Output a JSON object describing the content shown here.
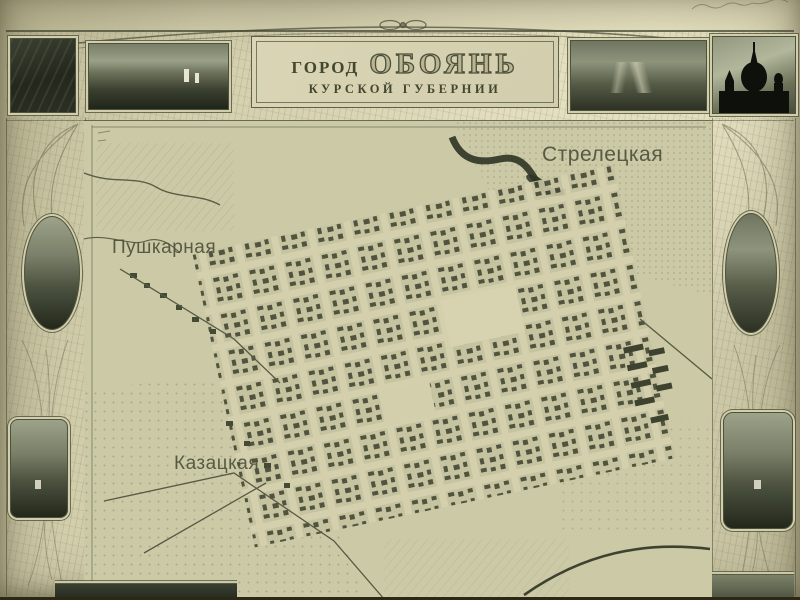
{
  "title": {
    "prefix": "ГОРОД",
    "name": "ОБОЯНЬ",
    "subtitle": "КУРСКОЙ ГУБЕРНИИ"
  },
  "map": {
    "districts": [
      {
        "label": "Стрелецкая"
      },
      {
        "label": "Пушкарная"
      },
      {
        "label": "Казацкая"
      }
    ]
  },
  "photos": {
    "top_left_corner": "dark town view",
    "top_left_panorama": "town panorama with white church",
    "top_right_panorama": "town panorama with winding road",
    "top_right_corner": "cathedral silhouette against sky",
    "left_oval": "town rooftops view",
    "right_oval": "river landscape view",
    "left_lower": "valley panorama",
    "right_lower": "fields panorama",
    "bottom_left_cropped": "photo (cut off at edge)",
    "bottom_right_cropped": "photo (cut off at edge)"
  },
  "annotations": {
    "top_right_handwriting": "illegible pencil inscription"
  },
  "colors": {
    "paper": "#d2ceac",
    "map_bg": "#cccaa6",
    "ink": "#4b4f3a",
    "photo_dark": "#23281d",
    "frame": "#5d6147"
  }
}
